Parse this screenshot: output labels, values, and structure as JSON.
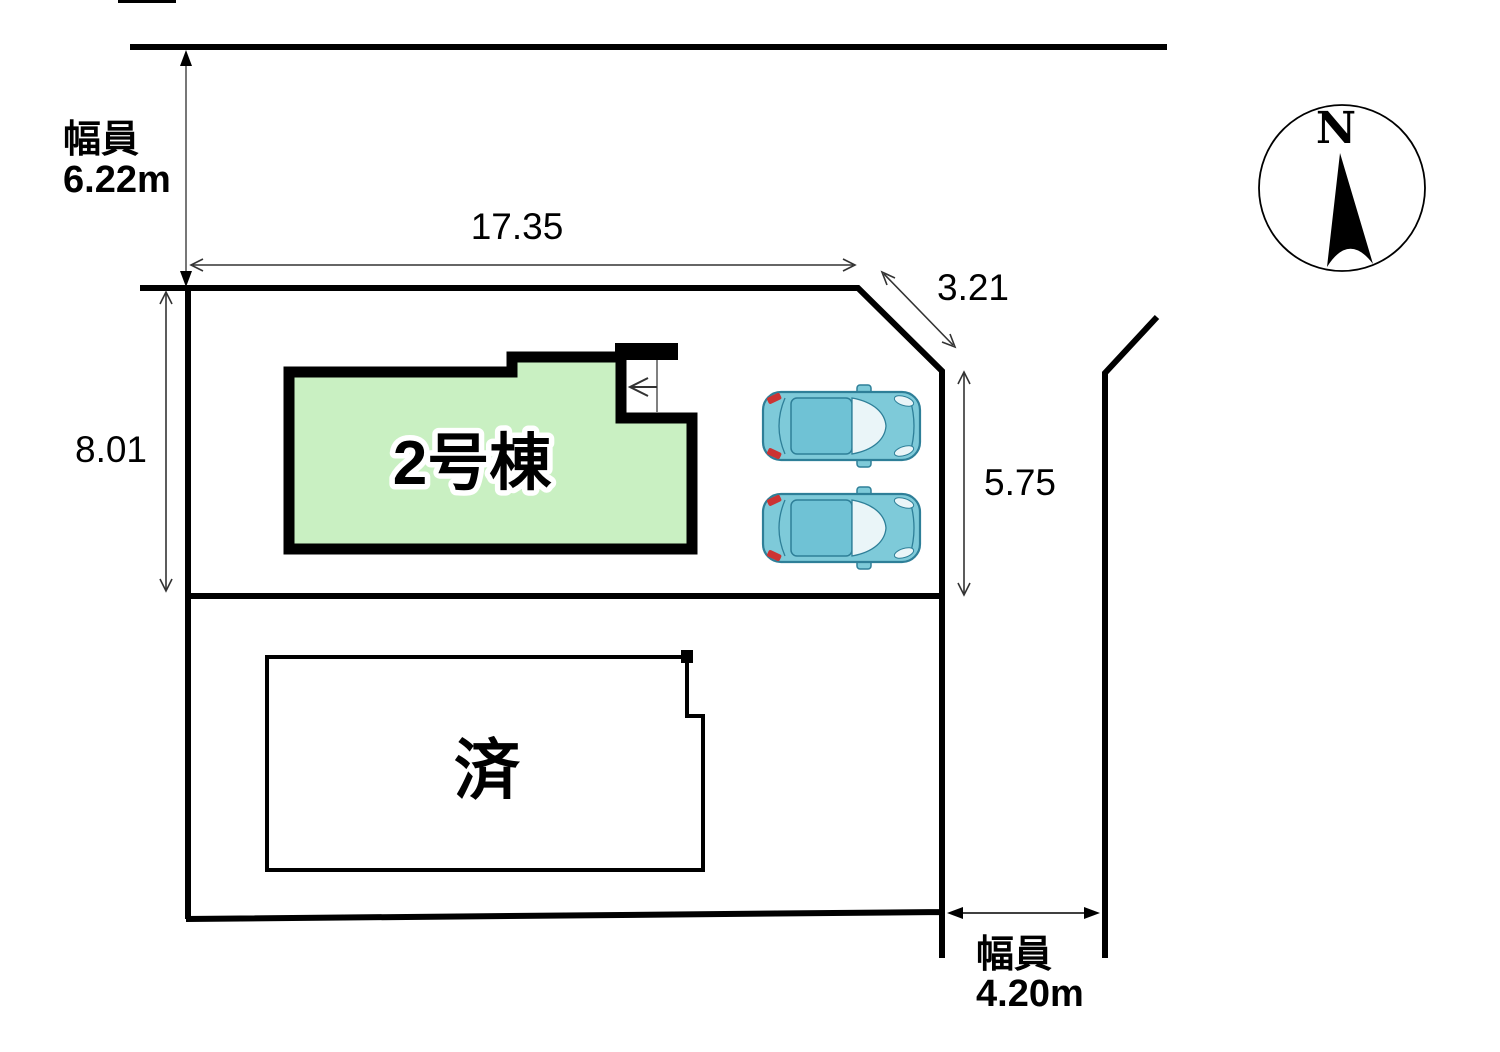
{
  "compass": {
    "label": "N"
  },
  "roads": {
    "top": {
      "width_label_line1": "幅員",
      "width_label_line2": "6.22m"
    },
    "right": {
      "width_label_line1": "幅員",
      "width_label_line2": "4.20m"
    }
  },
  "dimensions": {
    "frontage_top": "17.35",
    "corner_cut": "3.21",
    "depth_left": "8.01",
    "depth_right": "5.75"
  },
  "buildings": {
    "unit2": {
      "label": "2号棟"
    },
    "sold": {
      "label": "済"
    }
  },
  "colors": {
    "building_fill": "#c9f0c2",
    "outline": "#000000",
    "dimension_line": "#444444",
    "car_body": "#7ecad9",
    "car_roof": "#6fc2d5",
    "car_window": "#eaf5f8",
    "car_outline": "#2e7f98",
    "car_taillight": "#cc3333"
  }
}
